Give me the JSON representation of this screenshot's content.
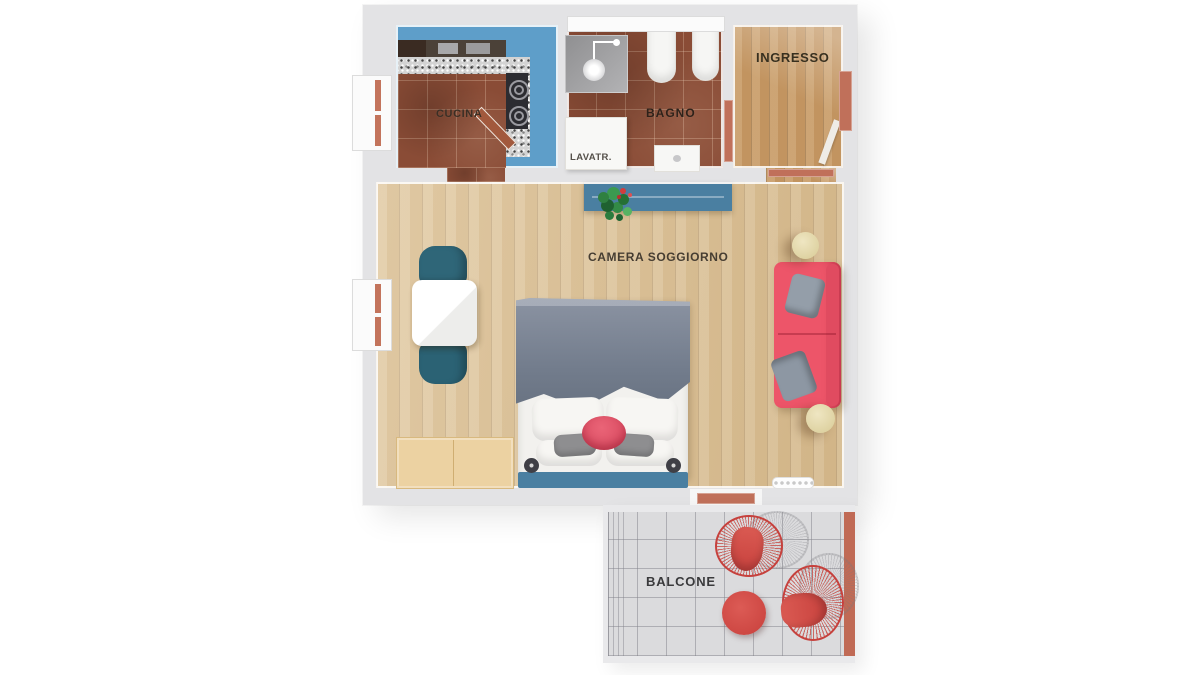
{
  "page": {
    "description": "Top-down 3D rendered apartment floor plan with balcony"
  },
  "rooms": {
    "cucina": {
      "label": "CUCINA"
    },
    "bagno": {
      "label": "BAGNO",
      "washer_label": "LAVATR."
    },
    "ingresso": {
      "label": "INGRESSO"
    },
    "camera_soggiorno": {
      "label": "CAMERA SOGGIORNO"
    },
    "balcone": {
      "label": "BALCONE"
    }
  },
  "colors": {
    "wall": "#e3e3e5",
    "kitchen_floor_blue": "#5e9ec9",
    "terracotta_tile": "#8a4c36",
    "ingresso_wood": "#c29460",
    "living_wood": "#d9bd90",
    "cabinet_blue": "#4a7fa1",
    "chair_teal": "#2f6678",
    "sofa_red": "#ed5569",
    "balcony_red": "#d5504c",
    "door_copper": "#c0705a",
    "duvet_gray": "#7d8695",
    "balcony_floor": "#dbdbdd",
    "pouf_cream": "#e8ddb0"
  },
  "icons": {
    "shower_icon": "overhead shower arm with round head",
    "stove_burner_icon": "concentric circle hob rings",
    "plant_icon": "green foliage cluster with red blooms"
  }
}
